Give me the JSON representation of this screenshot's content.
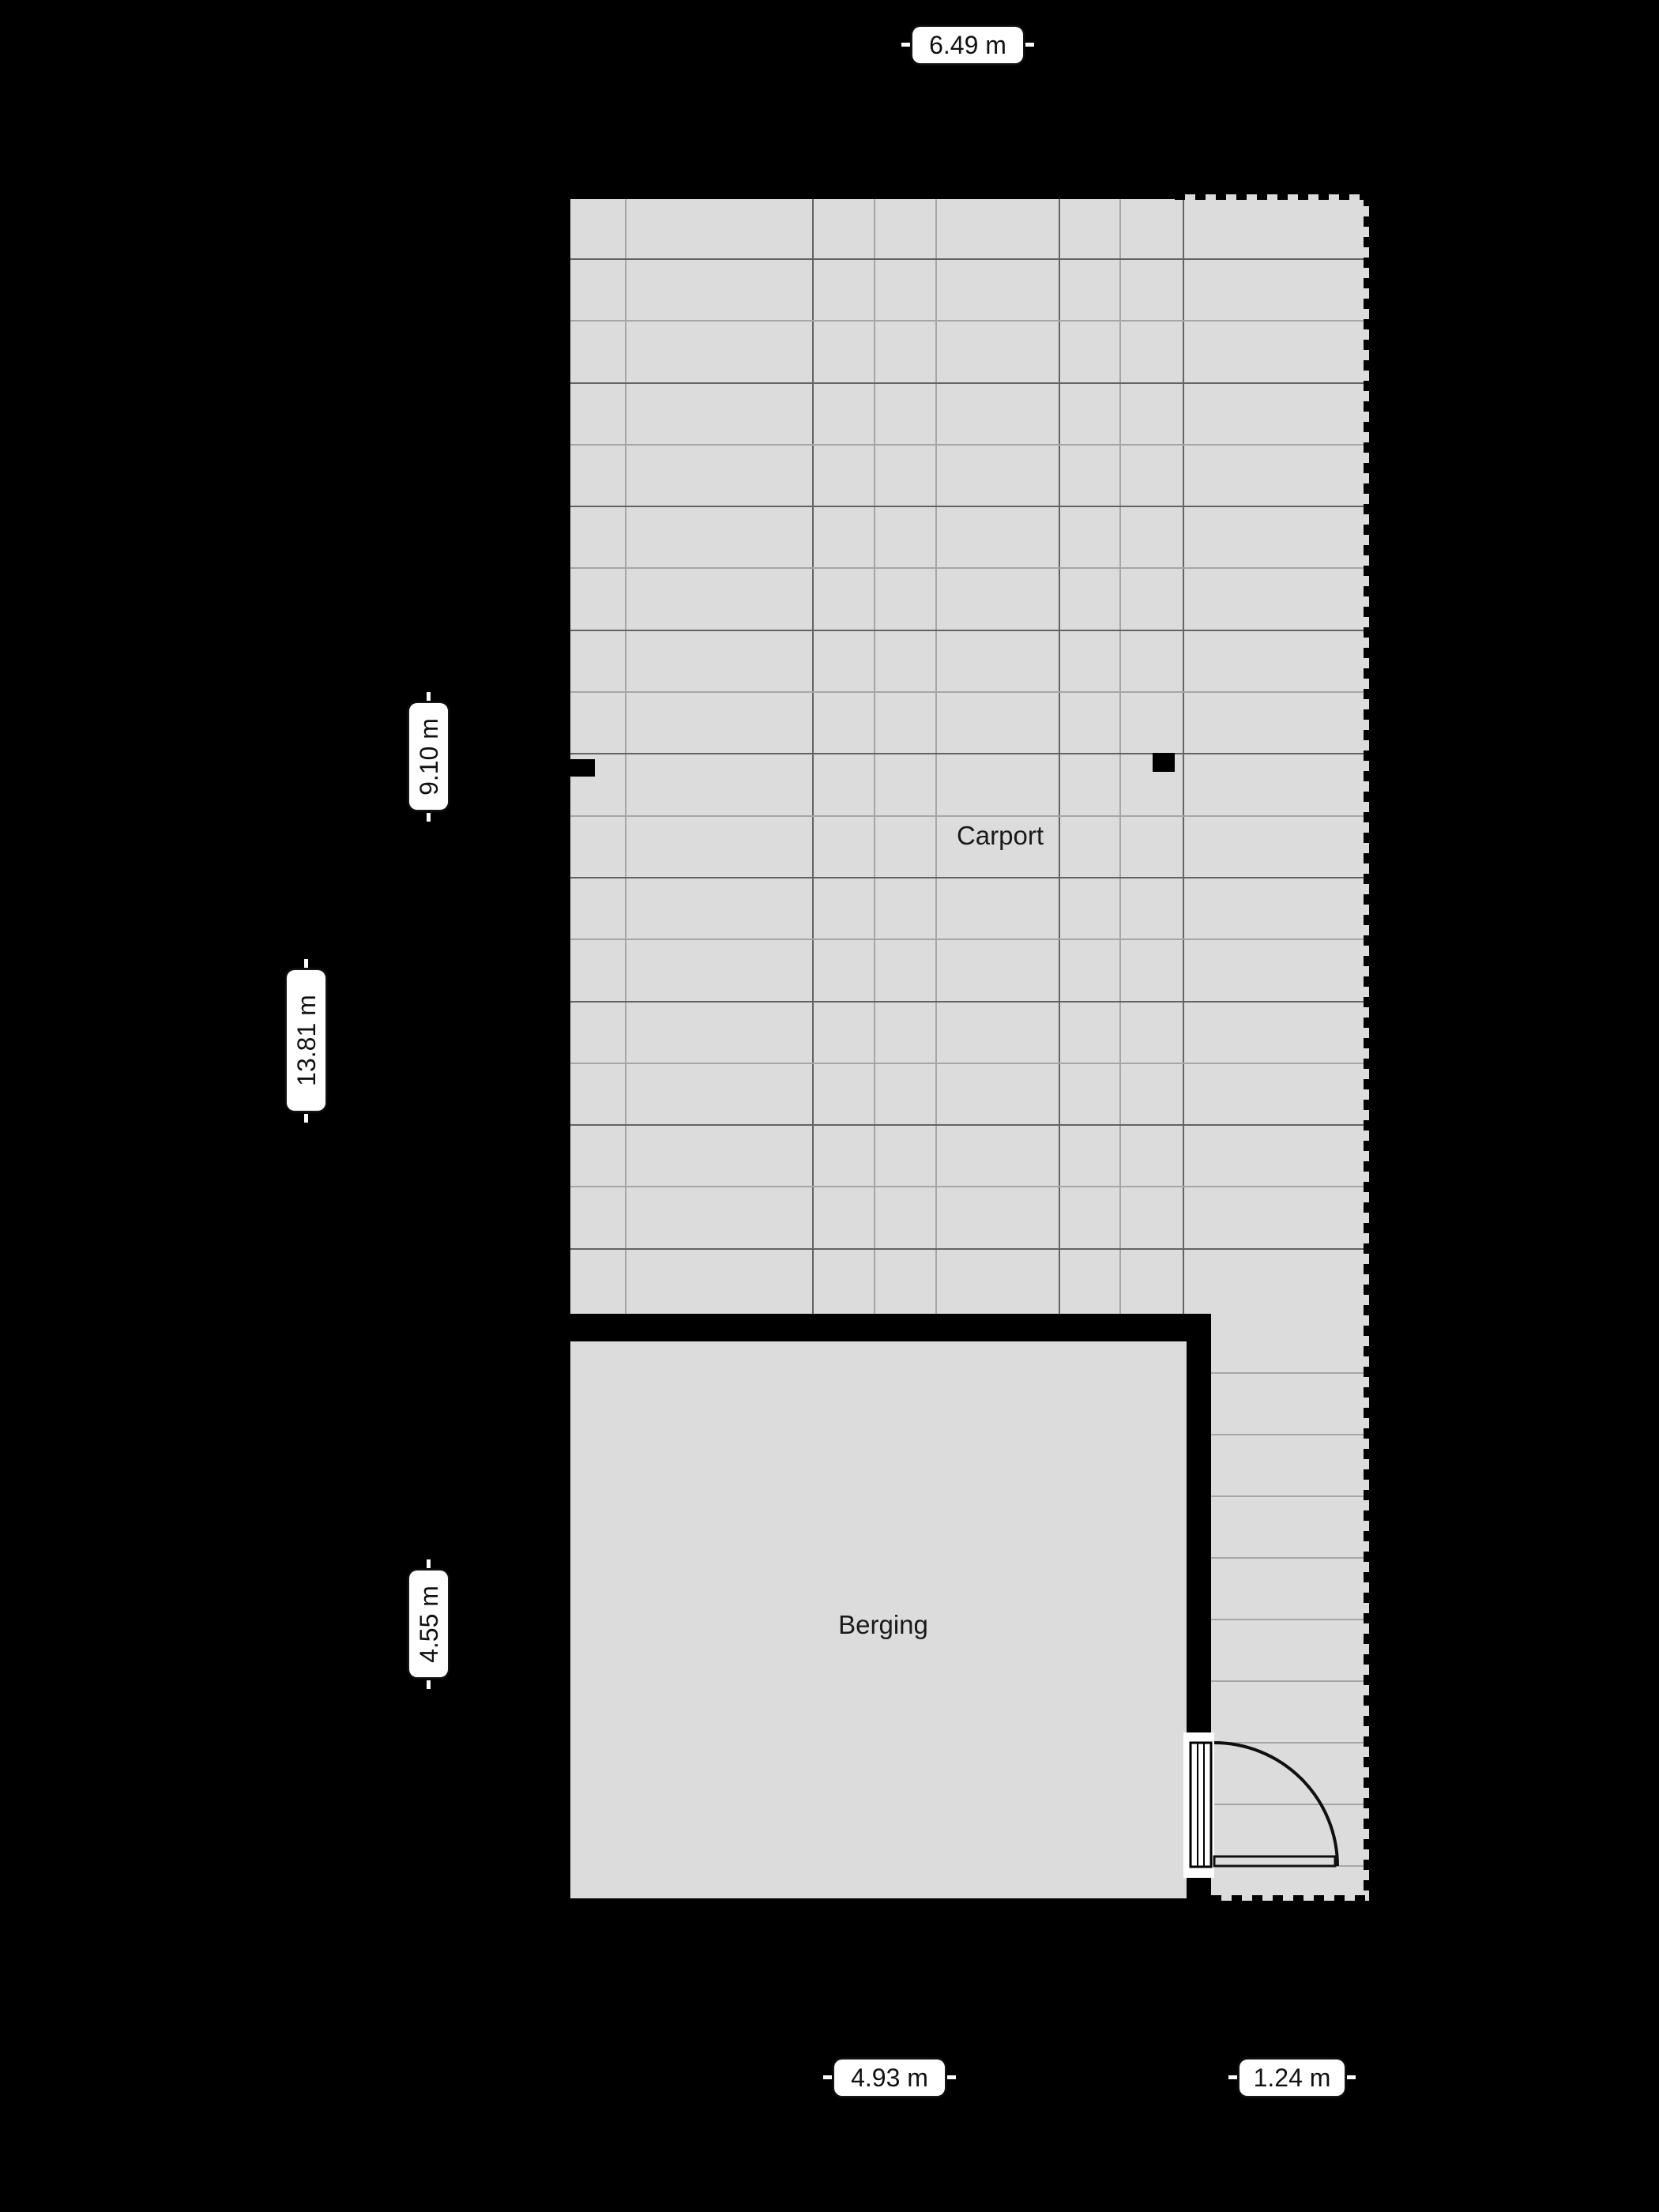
{
  "rooms": {
    "carport": {
      "name": "Carport"
    },
    "berging": {
      "name": "Berging"
    }
  },
  "dimensions": {
    "top_total_width": "6.49 m",
    "left_carport_depth": "9.10 m",
    "left_total_depth": "13.81 m",
    "left_berging_depth": "4.55 m",
    "bottom_berging_width": "4.93 m",
    "bottom_strip_width": "1.24 m"
  },
  "colors": {
    "background": "#000000",
    "floor": "#dcdcdd",
    "wall": "#000000",
    "grid_dark": "#636363",
    "grid_light": "#a6a6a6",
    "label_bg": "#ffffff",
    "label_text": "#111111"
  }
}
